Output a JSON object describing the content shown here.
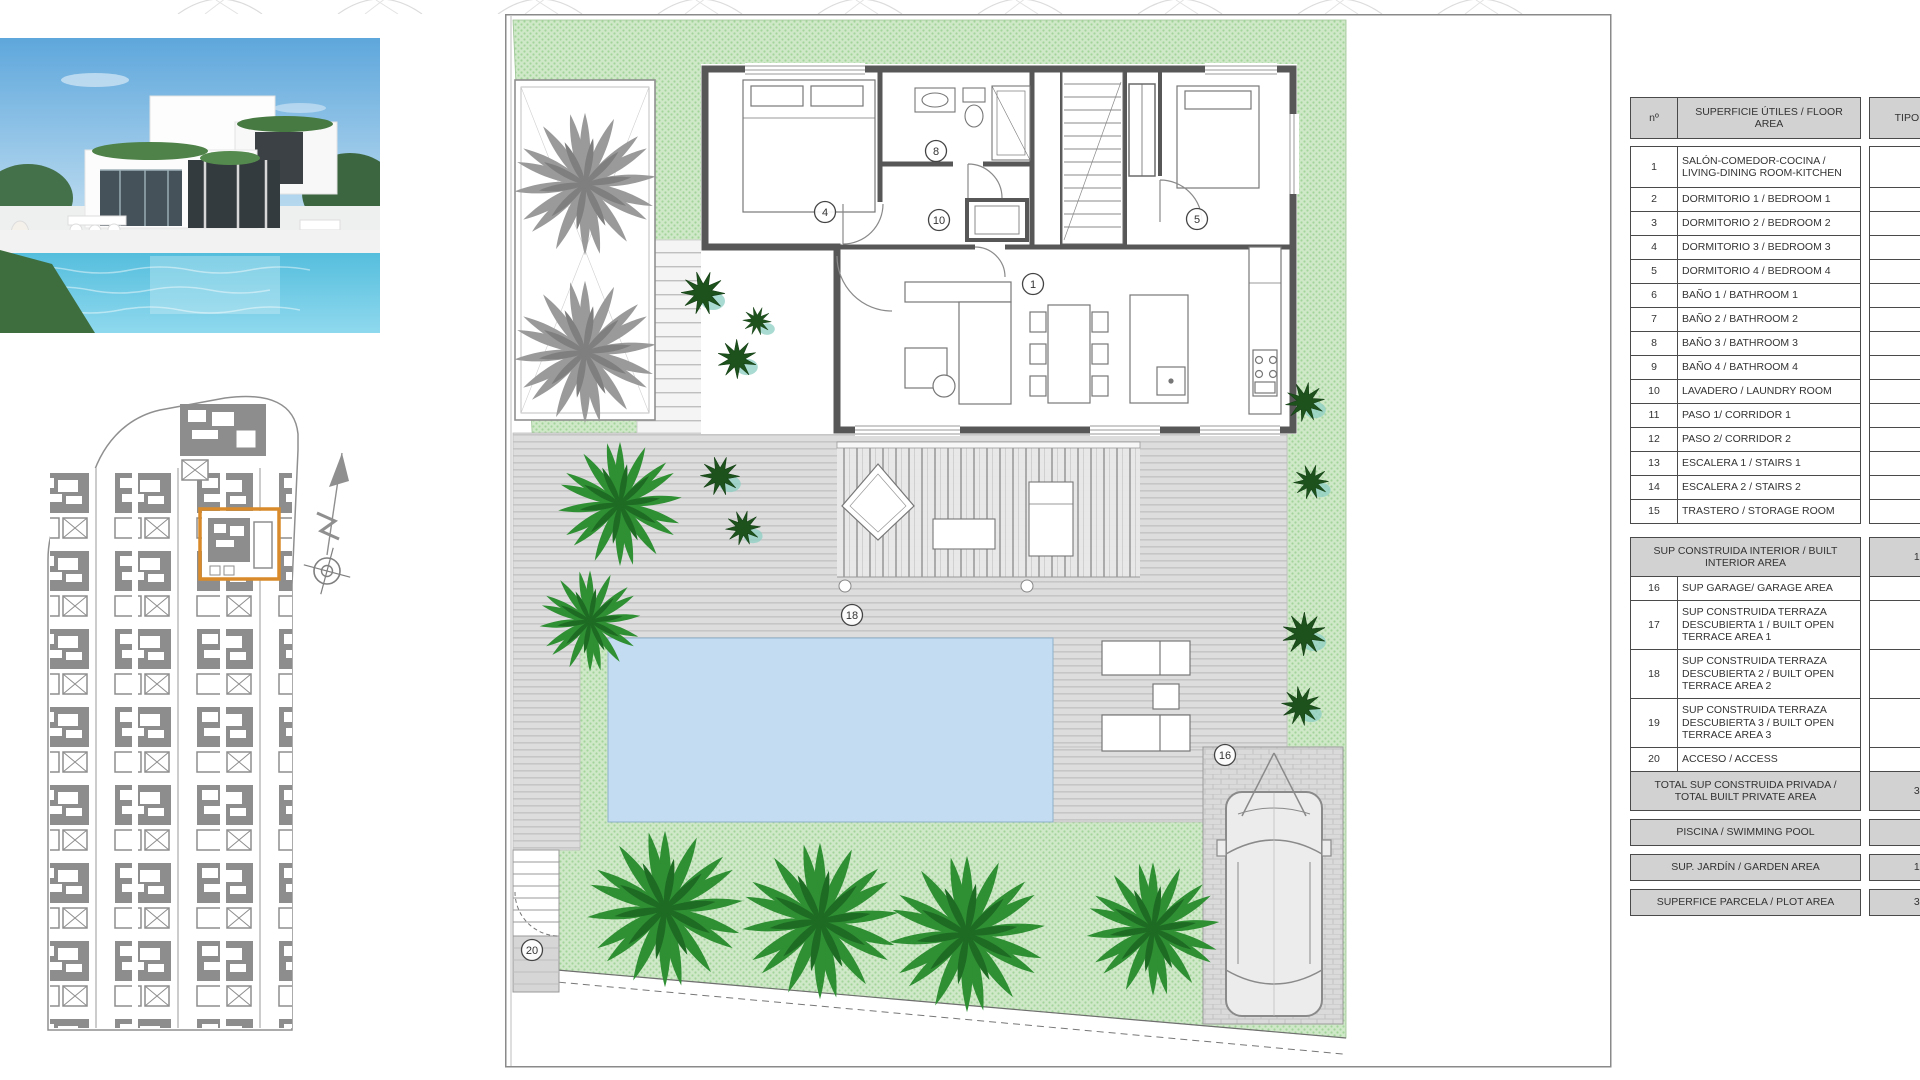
{
  "document": {
    "type": "architectural-plan-sheet",
    "colors": {
      "highlight_orange": "#D98B2B",
      "garden_green": "#CFE8C8",
      "pool_blue": "#C3DCF2",
      "deck_gray": "#DDDDDD",
      "wall_gray": "#575757",
      "bush_green": "#1D521D",
      "palm_green": "#2F8F33",
      "siteplan_gray": "#8D8D8D"
    }
  },
  "floor_plan": {
    "labels": [
      {
        "n": "4",
        "x": 320,
        "y": 198
      },
      {
        "n": "8",
        "x": 431,
        "y": 137
      },
      {
        "n": "10",
        "x": 434,
        "y": 206
      },
      {
        "n": "5",
        "x": 692,
        "y": 205
      },
      {
        "n": "1",
        "x": 528,
        "y": 270
      },
      {
        "n": "18",
        "x": 347,
        "y": 601
      },
      {
        "n": "16",
        "x": 720,
        "y": 741
      },
      {
        "n": "20",
        "x": 27,
        "y": 936
      }
    ]
  },
  "area_table": {
    "headers": {
      "num": "nº",
      "label": "SUPERFICIE ÚTILES / FLOOR AREA",
      "value": "TIPO 2-"
    },
    "rows": [
      {
        "kind": "item",
        "num": "1",
        "label": "SALÓN-COMEDOR-COCINA / LIVING-DINING ROOM-KITCHEN",
        "value": "31,15",
        "lines": 2,
        "gap": 8
      },
      {
        "kind": "item",
        "num": "2",
        "label": "DORMITORIO 1 / BEDROOM 1",
        "value": "11,40",
        "lines": 1
      },
      {
        "kind": "item",
        "num": "3",
        "label": "DORMITORIO 2 / BEDROOM 2",
        "value": "10,25",
        "lines": 1
      },
      {
        "kind": "item",
        "num": "4",
        "label": "DORMITORIO 3 / BEDROOM 3",
        "value": "10,10",
        "lines": 1
      },
      {
        "kind": "item",
        "num": "5",
        "label": "DORMITORIO 4 / BEDROOM 4",
        "value": "8,70",
        "lines": 1
      },
      {
        "kind": "item",
        "num": "6",
        "label": "BAÑO 1 / BATHROOM 1",
        "value": "4,05",
        "lines": 1
      },
      {
        "kind": "item",
        "num": "7",
        "label": "BAÑO 2 / BATHROOM 2",
        "value": "4,35",
        "lines": 1
      },
      {
        "kind": "item",
        "num": "8",
        "label": "BAÑO 3 / BATHROOM 3",
        "value": "3,50",
        "lines": 1
      },
      {
        "kind": "item",
        "num": "9",
        "label": "BAÑO 4 / BATHROOM 4",
        "value": "5,80",
        "lines": 1
      },
      {
        "kind": "item",
        "num": "10",
        "label": "LAVADERO / LAUNDRY ROOM",
        "value": "6,45",
        "lines": 1
      },
      {
        "kind": "item",
        "num": "11",
        "label": "PASO 1/ CORRIDOR 1",
        "value": "1,70",
        "lines": 1
      },
      {
        "kind": "item",
        "num": "12",
        "label": "PASO 2/ CORRIDOR 2",
        "value": "3,75",
        "lines": 1
      },
      {
        "kind": "item",
        "num": "13",
        "label": "ESCALERA 1 / STAIRS 1",
        "value": "4,70",
        "lines": 1
      },
      {
        "kind": "item",
        "num": "14",
        "label": "ESCALERA 2 / STAIRS 2",
        "value": "5,40",
        "lines": 1
      },
      {
        "kind": "item",
        "num": "15",
        "label": "TRASTERO / STORAGE ROOM",
        "value": "26,05",
        "lines": 1
      },
      {
        "kind": "section",
        "label": "SUP CONSTRUIDA INTERIOR / BUILT INTERIOR AREA",
        "value": "170,13",
        "lines": 2,
        "gap": 14
      },
      {
        "kind": "item",
        "num": "16",
        "label": "SUP GARAGE/ GARAGE AREA",
        "value": "17,05",
        "lines": 1
      },
      {
        "kind": "item",
        "num": "17",
        "label": "SUP CONSTRUIDA TERRAZA DESCUBIERTA 1 / BUILT OPEN TERRACE AREA 1",
        "value": "28,35",
        "lines": 3
      },
      {
        "kind": "item",
        "num": "18",
        "label": "SUP CONSTRUIDA TERRAZA DESCUBIERTA 2 / BUILT OPEN TERRACE AREA 2",
        "value": "71,15",
        "lines": 3
      },
      {
        "kind": "item",
        "num": "19",
        "label": "SUP CONSTRUIDA TERRAZA DESCUBIERTA 3 / BUILT OPEN TERRACE AREA 3",
        "value": "21,65",
        "lines": 3
      },
      {
        "kind": "item",
        "num": "20",
        "label": "ACCESO / ACCESS",
        "value": "4,45",
        "lines": 1
      },
      {
        "kind": "total",
        "label": "TOTAL SUP CONSTRUIDA PRIVADA / TOTAL BUILT PRIVATE AREA",
        "value": "312,78",
        "lines": 2
      },
      {
        "kind": "summary",
        "label": "PISCINA / SWIMMING POOL",
        "value": "30,60",
        "lines": 1,
        "gap": 9
      },
      {
        "kind": "summary",
        "label": "SUP. JARDÍN / GARDEN AREA",
        "value": "102,65",
        "lines": 1,
        "gap": 9
      },
      {
        "kind": "summary",
        "label": "SUPERFICE PARCELA / PLOT AREA",
        "value": "330,55",
        "lines": 1,
        "gap": 9
      }
    ]
  }
}
